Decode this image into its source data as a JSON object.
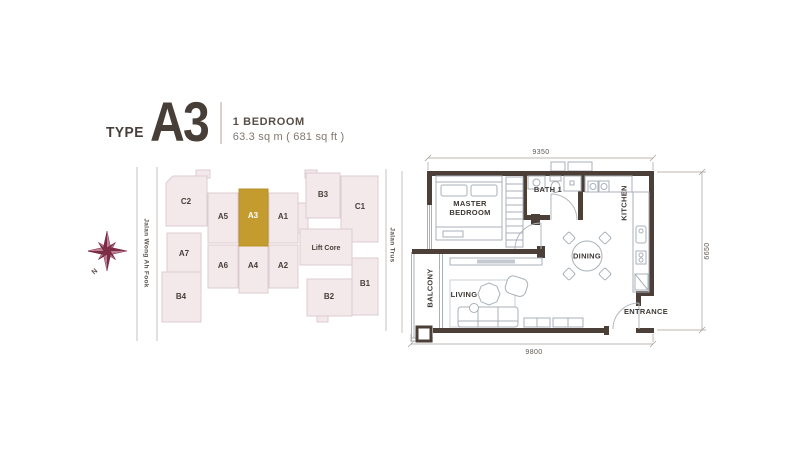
{
  "title": {
    "type_label": "TYPE",
    "type_code": "A3",
    "bedroom_label": "1 BEDROOM",
    "area_label": "63.3 sq m ( 681 sq ft )"
  },
  "key_plan": {
    "compass": {
      "label": "N",
      "color": "#7c2b45"
    },
    "streets": {
      "left": "Jalan Wong Ah Fook",
      "right": "Jalan Trus"
    },
    "lift_core_label": "Lift Core",
    "highlighted_unit": "A3",
    "units": {
      "c2": "C2",
      "a5": "A5",
      "a3": "A3",
      "a1": "A1",
      "b3": "B3",
      "c1": "C1",
      "a7": "A7",
      "a6": "A6",
      "a4": "A4",
      "a2": "A2",
      "b1": "B1",
      "b2": "B2",
      "b4": "B4"
    },
    "colors": {
      "unit_fill": "#f3e9eb",
      "unit_stroke": "#dccbd1",
      "highlight_fill": "#c49b2e",
      "unit_label": "#4a3e38",
      "highlight_label": "#ffffff"
    }
  },
  "floor_plan": {
    "rooms": {
      "master_bedroom_l1": "MASTER",
      "master_bedroom_l2": "BEDROOM",
      "bath": "BATH 1",
      "kitchen": "KITCHEN",
      "dining": "DINING",
      "living": "LIVING",
      "balcony": "BALCONY",
      "entrance": "ENTRANCE"
    },
    "dimensions": {
      "top": "9350",
      "right": "6650",
      "bottom": "9800"
    },
    "colors": {
      "wall": "#4b3f37",
      "fixture": "#a8b1b8",
      "dimension": "#5f5852"
    }
  }
}
